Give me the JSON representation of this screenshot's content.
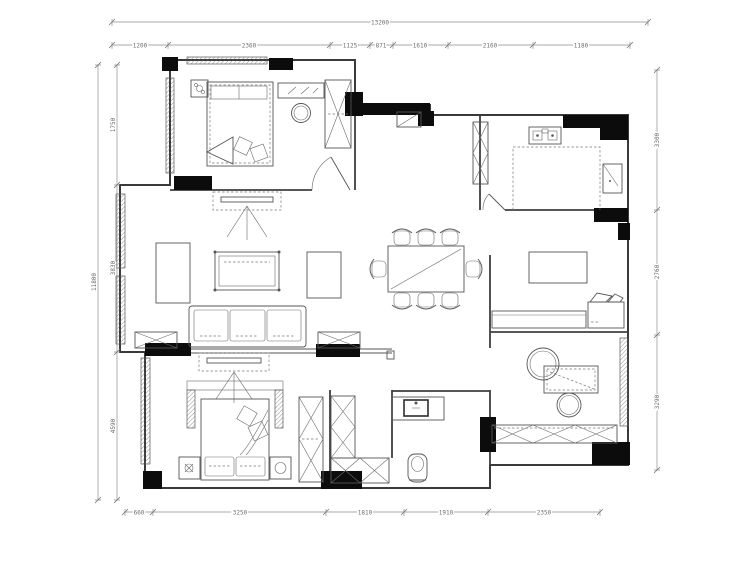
{
  "drawing": {
    "type": "apartment-floor-plan",
    "background": "#ffffff",
    "line_color": "#3f3f3f",
    "wall_pier_color": "#0c0c0c",
    "rooms": [
      "bedroom-top-left",
      "entry-hall",
      "kitchen",
      "living-room",
      "dining-area",
      "master-bedroom",
      "bathroom",
      "study"
    ],
    "furniture": [
      "double-bed",
      "nightstand",
      "dresser",
      "stool",
      "wardrobe",
      "shoe-cabinet",
      "hall-cabinet",
      "kitchen-counter",
      "stove",
      "fridge",
      "tv-cabinet",
      "coffee-table",
      "side-table",
      "sofa-3-seat",
      "end-table",
      "dining-table-8-chairs",
      "sideboard",
      "low-cabinet",
      "armchair",
      "desk",
      "round-chair",
      "bookshelf",
      "vanity-sink",
      "toilet",
      "storage-cabinet"
    ]
  },
  "dimensions": {
    "top_total": "13200",
    "top_segments": [
      "1200",
      "2360",
      "1125",
      "871",
      "1610",
      "2160",
      "1180"
    ],
    "bottom_segments": [
      "660",
      "3250",
      "1810",
      "1910",
      "2350"
    ],
    "left_total": "11800",
    "left_segments": [
      "1750",
      "3830",
      "4590"
    ],
    "right_segments": [
      "3300",
      "2760",
      "3290"
    ]
  }
}
